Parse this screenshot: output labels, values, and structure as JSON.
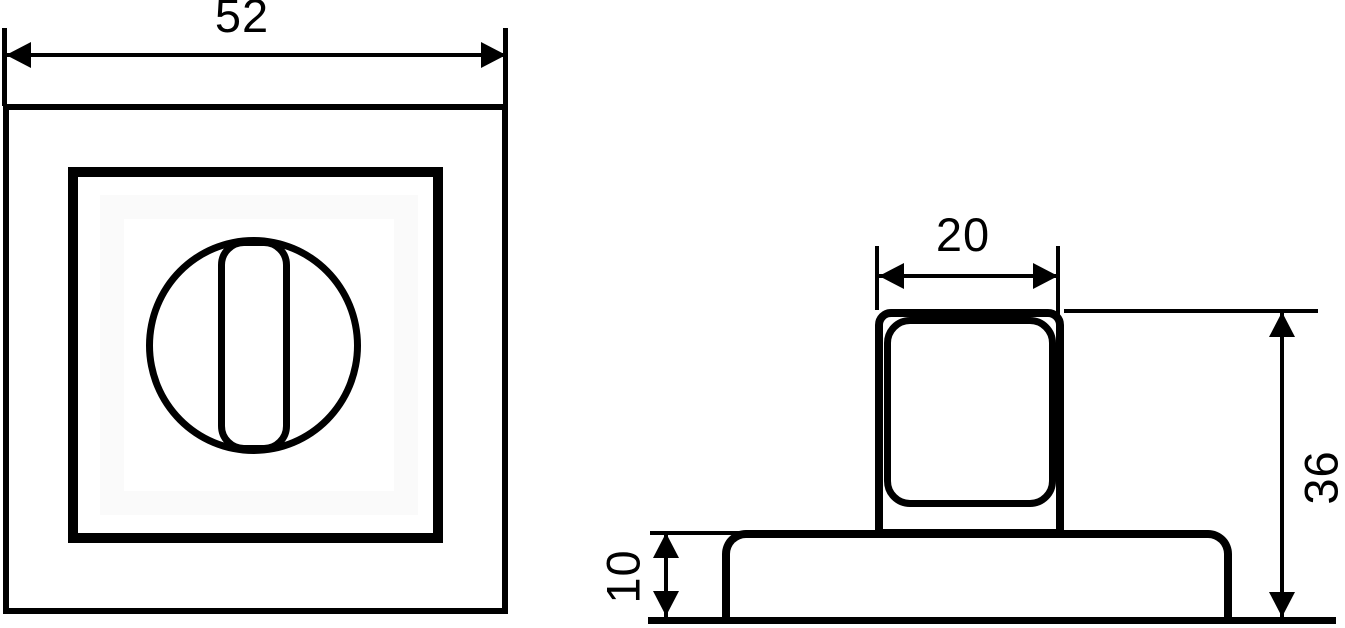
{
  "dimension_labels": {
    "plate_width": "52",
    "knob_width": "20",
    "overall_height": "36",
    "base_height": "10"
  },
  "colors": {
    "line": "#000000",
    "background": "#ffffff",
    "plate_inner_highlight": "#fafafa"
  }
}
